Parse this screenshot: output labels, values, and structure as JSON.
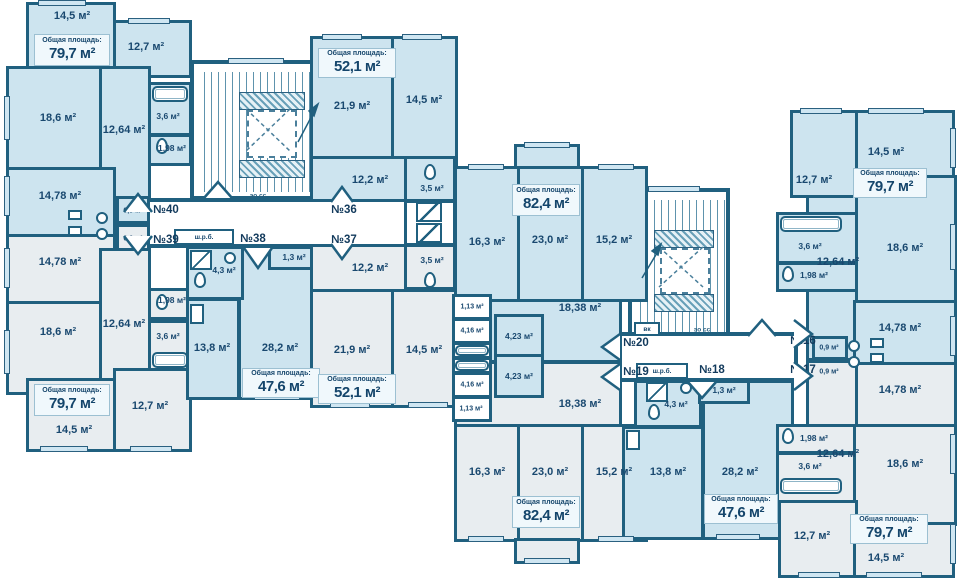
{
  "legend": {
    "total": "Общая площадь:",
    "shrb": "ш.р.б.",
    "vk": "вк",
    "stair": "эо сс"
  },
  "apts": {
    "a40": {
      "num": "№40",
      "total": "79,7 м²",
      "rooms": {
        "r14_5": "14,5 м²",
        "r12_7": "12,7 м²",
        "r18_6": "18,6 м²",
        "r12_64": "12,64 м²",
        "r3_6": "3,6 м²",
        "r1_98": "1,98 м²",
        "r14_78": "14,78 м²",
        "r0_9": "0,9 м²"
      }
    },
    "a39": {
      "num": "№39",
      "total": "79,7 м²",
      "rooms": {
        "r14_5": "14,5 м²",
        "r12_7": "12,7 м²",
        "r18_6": "18,6 м²",
        "r12_64": "12,64 м²",
        "r3_6": "3,6 м²",
        "r1_98": "1,98 м²",
        "r14_78": "14,78 м²",
        "r0_9": "0,9 м²"
      }
    },
    "a38": {
      "num": "№38",
      "total": "47,6 м²",
      "rooms": {
        "r1_3": "1,3 м²",
        "r4_3": "4,3 м²",
        "r13_8": "13,8 м²",
        "r28_2": "28,2 м²"
      }
    },
    "a36": {
      "num": "№36",
      "total": "52,1 м²",
      "rooms": {
        "r21_9": "21,9 м²",
        "r14_5": "14,5 м²",
        "r12_2": "12,2 м²",
        "r3_5": "3,5 м²"
      }
    },
    "a37": {
      "num": "№37",
      "total": "52,1 м²",
      "rooms": {
        "r21_9": "21,9 м²",
        "r14_5": "14,5 м²",
        "r12_2": "12,2 м²",
        "r3_5": "3,5 м²"
      }
    },
    "a20": {
      "num": "№20",
      "total": "82,4 м²",
      "rooms": {
        "r16_3": "16,3 м²",
        "r23_0": "23,0 м²",
        "r15_2": "15,2 м²",
        "r18_38": "18,38 м²",
        "r1_13": "1,13 м²",
        "r4_16": "4,16 м²",
        "r4_23": "4,23 м²"
      }
    },
    "a19": {
      "num": "№19",
      "total": "82,4 м²",
      "rooms": {
        "r16_3": "16,3 м²",
        "r23_0": "23,0 м²",
        "r15_2": "15,2 м²",
        "r18_38": "18,38 м²",
        "r1_13": "1,13 м²",
        "r4_16": "4,16 м²",
        "r4_23": "4,23 м²"
      }
    },
    "a18": {
      "num": "№18",
      "total": "47,6 м²",
      "rooms": {
        "r1_3": "1,3 м²",
        "r4_3": "4,3 м²",
        "r13_8": "13,8 м²",
        "r28_2": "28,2 м²"
      }
    },
    "a16": {
      "num": "№16",
      "total": "79,7 м²",
      "rooms": {
        "r12_7": "12,7 м²",
        "r14_5": "14,5 м²",
        "r18_6": "18,6 м²",
        "r12_64": "12,64 м²",
        "r3_6": "3,6 м²",
        "r1_98": "1,98 м²",
        "r14_78": "14,78 м²",
        "r0_9": "0,9 м²"
      }
    },
    "a17": {
      "num": "№17",
      "total": "79,7 м²",
      "rooms": {
        "r12_7": "12,7 м²",
        "r14_5": "14,5 м²",
        "r18_6": "18,6 м²",
        "r12_64": "12,64 м²",
        "r3_6": "3,6 м²",
        "r1_98": "1,98 м²",
        "r14_78": "14,78 м²",
        "r0_9": "0,9 м²"
      }
    }
  },
  "colors": {
    "wall": "#20607f",
    "room_blue": "#cde4ef",
    "room_gray": "#e8edf0",
    "label": "#19486f"
  }
}
